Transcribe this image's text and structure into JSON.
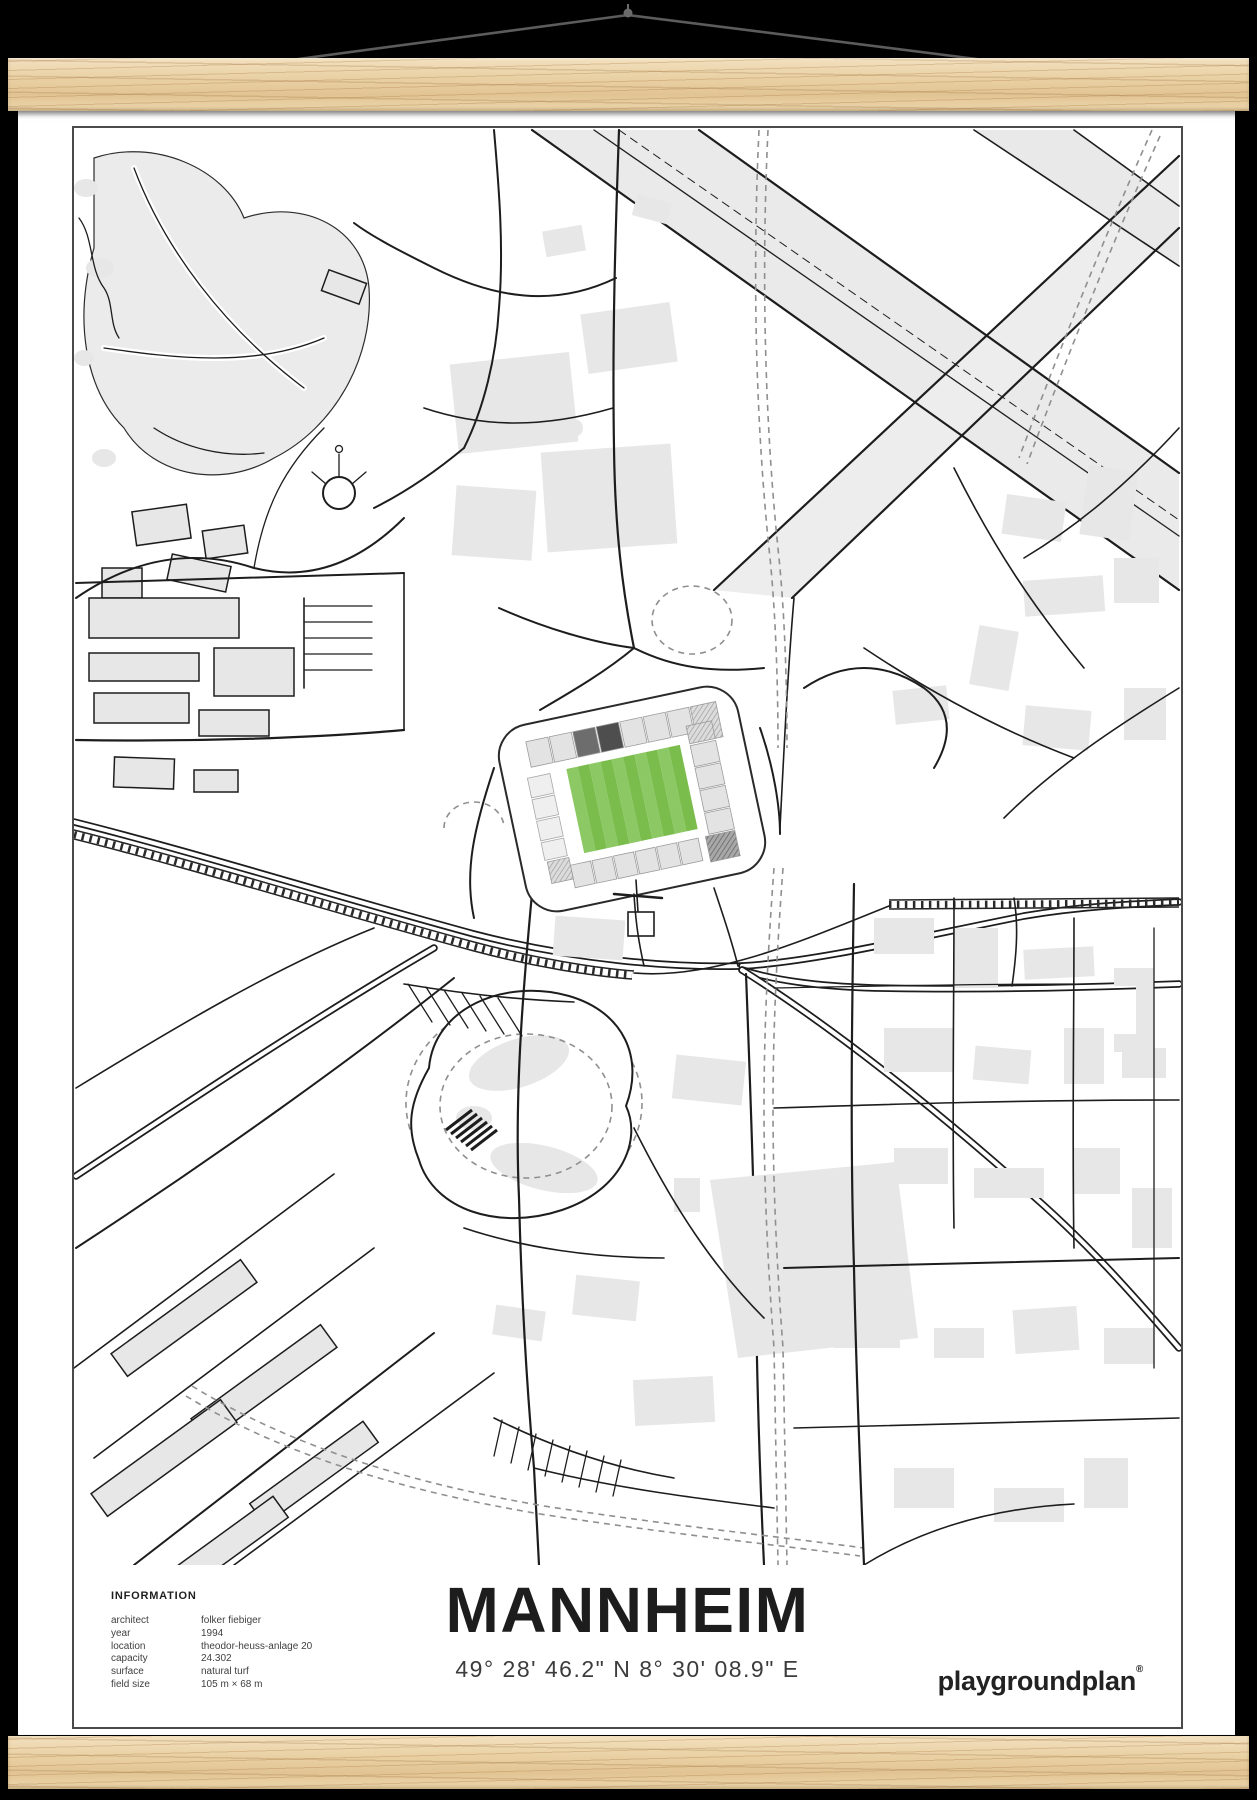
{
  "scene": {
    "background": "#000000"
  },
  "hanger": {
    "string_color": "#5c5c5c",
    "wood_color": "#e9d0a6"
  },
  "poster": {
    "title": "MANNHEIM",
    "coordinates": "49° 28' 46.2\" N 8° 30' 08.9\" E",
    "brand": "playgroundplan",
    "brand_mark": "®",
    "info": {
      "heading": "INFORMATION",
      "rows": [
        {
          "label": "architect",
          "value": "folker fiebiger"
        },
        {
          "label": "year",
          "value": "1994"
        },
        {
          "label": "location",
          "value": "theodor-heuss-anlage 20"
        },
        {
          "label": "capacity",
          "value": "24.302"
        },
        {
          "label": "surface",
          "value": "natural turf"
        },
        {
          "label": "field size",
          "value": "105 m × 68 m"
        }
      ]
    },
    "map": {
      "pitch_color_light": "#8cc863",
      "pitch_color_dark": "#7abd4d",
      "building_color": "#e7e7e7",
      "street_color": "#1d1d1d"
    }
  }
}
